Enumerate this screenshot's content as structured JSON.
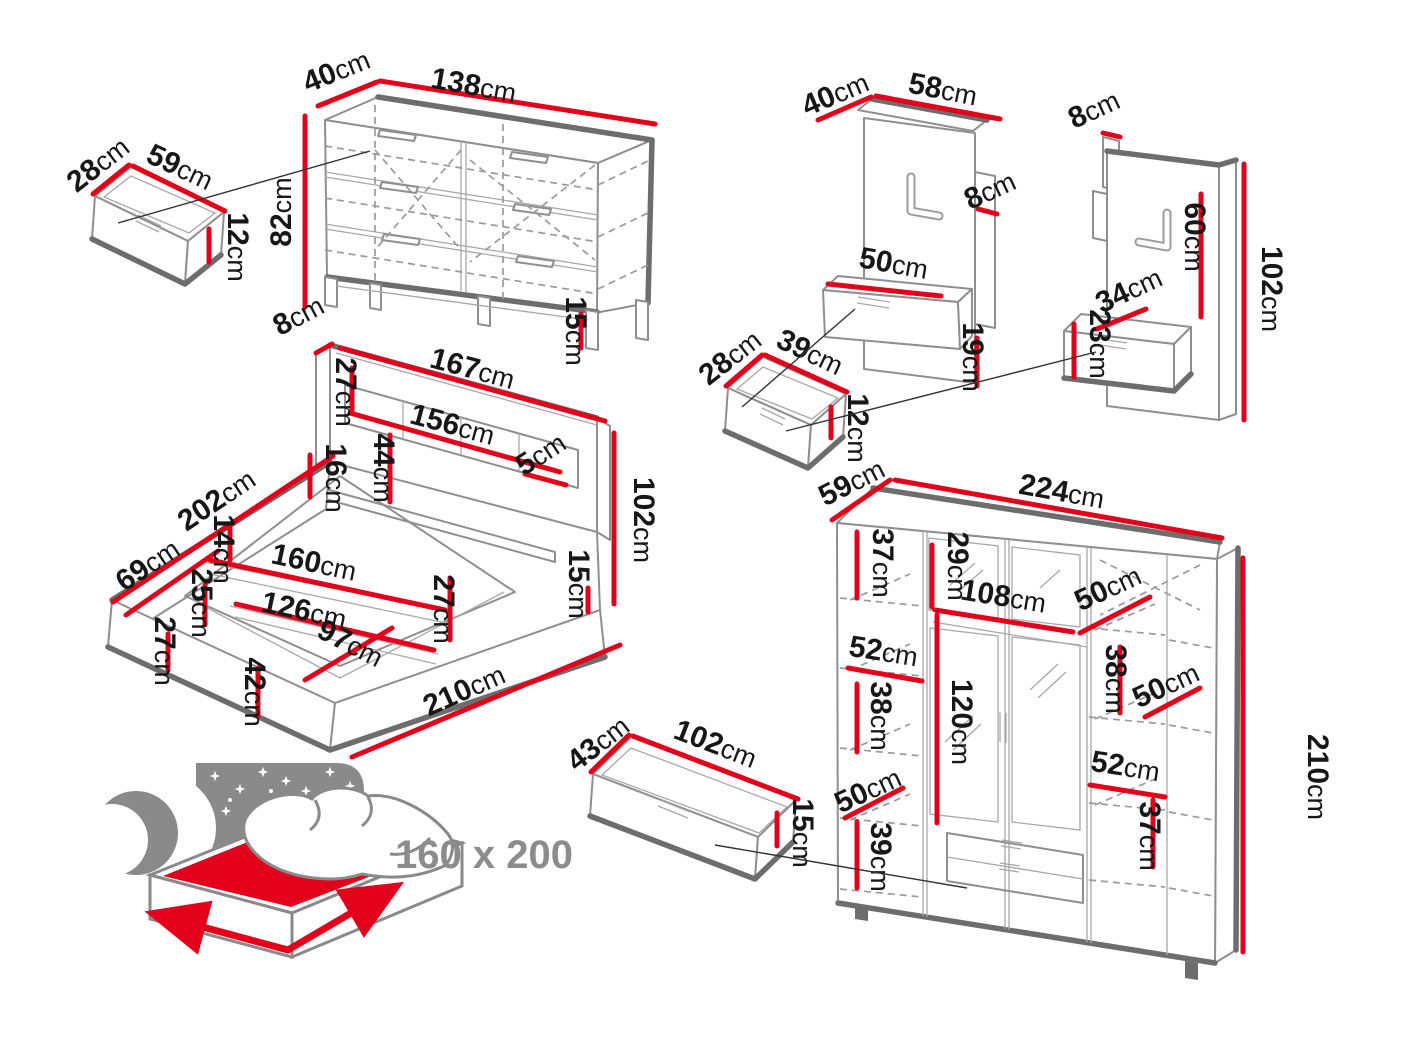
{
  "unit": "cm",
  "colors": {
    "dimension_red": "#e2001a",
    "outline_gray": "#8f8f8f",
    "shadow_gray": "#6d6d6d",
    "label_text": "#171717",
    "icon_gray": "#8c8c8c"
  },
  "pieces": {
    "chest": {
      "depth": "40",
      "width": "138",
      "height": "82",
      "leg_height": "15"
    },
    "chest_drawer": {
      "depth": "28",
      "width": "59",
      "height": "12"
    },
    "bed": {
      "headboard_depth": "8",
      "headboard_width": "167",
      "headboard_box_height": "27",
      "shelf_width": "156",
      "shelf_drop": "44",
      "shelf_thickness": "5",
      "ledge_height": "16",
      "height": "102",
      "side_length": "202",
      "side_section": "69",
      "step_height": "14",
      "inner_width": "160",
      "floor_width": "126",
      "inner_depth": "97",
      "rail_height": "25",
      "corner_height": "27",
      "foot_height": "42",
      "front_height": "27",
      "base_height": "15",
      "length": "210"
    },
    "panel_left": {
      "depth": "40",
      "width": "58",
      "batten_depth": "8",
      "drawer_width": "50",
      "lower_gap": "19"
    },
    "panel_drawer": {
      "depth": "28",
      "width": "39",
      "height": "12"
    },
    "panel_right": {
      "batten_depth": "8",
      "panel_height": "60",
      "height": "102",
      "drawer_depth": "34",
      "drawer_height": "23"
    },
    "wardrobe": {
      "depth": "59",
      "width": "224",
      "top_gap_left": "37",
      "top_door_height": "29",
      "middle_width": "108",
      "depth_top": "50",
      "shelf_left": "52",
      "gap_left": "38",
      "door_height": "120",
      "gap_right": "38",
      "depth_right": "50",
      "shelf_right": "52",
      "gap_lower_right": "37",
      "depth_lower_left": "50",
      "gap_lower_left": "39",
      "height": "210"
    },
    "wardrobe_drawer": {
      "depth": "43",
      "width": "102",
      "height": "15"
    },
    "bed_icon": {
      "size_label": "160 x 200"
    }
  }
}
